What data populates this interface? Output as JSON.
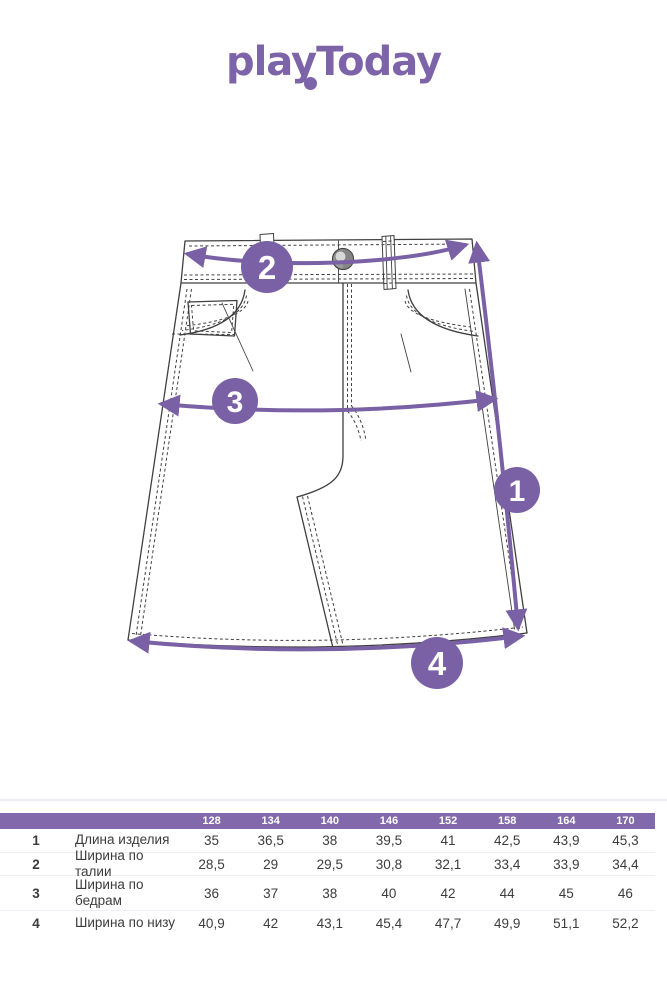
{
  "brand": {
    "logo_text": "playToday",
    "logo_color": "#7d63a8"
  },
  "diagram": {
    "accent_color": "#7a61a6",
    "line_color": "#404040",
    "subject": "denim-skirt-technical-drawing",
    "badges": [
      {
        "number": "1",
        "measures": "Длина изделия"
      },
      {
        "number": "2",
        "measures": "Ширина по талии"
      },
      {
        "number": "3",
        "measures": "Ширина по бедрам"
      },
      {
        "number": "4",
        "measures": "Ширина по низу"
      }
    ]
  },
  "size_table": {
    "header_bg": "#8169ac",
    "sizes": [
      "128",
      "134",
      "140",
      "146",
      "152",
      "158",
      "164",
      "170"
    ],
    "rows": [
      {
        "num": "1",
        "label": "Длина изделия",
        "values": [
          "35",
          "36,5",
          "38",
          "39,5",
          "41",
          "42,5",
          "43,9",
          "45,3"
        ]
      },
      {
        "num": "2",
        "label": "Ширина по талии",
        "values": [
          "28,5",
          "29",
          "29,5",
          "30,8",
          "32,1",
          "33,4",
          "33,9",
          "34,4"
        ]
      },
      {
        "num": "3",
        "label": "Ширина по\nбедрам",
        "values": [
          "36",
          "37",
          "38",
          "40",
          "42",
          "44",
          "45",
          "46"
        ]
      },
      {
        "num": "4",
        "label": "Ширина по низу",
        "values": [
          "40,9",
          "42",
          "43,1",
          "45,4",
          "47,7",
          "49,9",
          "51,1",
          "52,2"
        ]
      }
    ]
  }
}
